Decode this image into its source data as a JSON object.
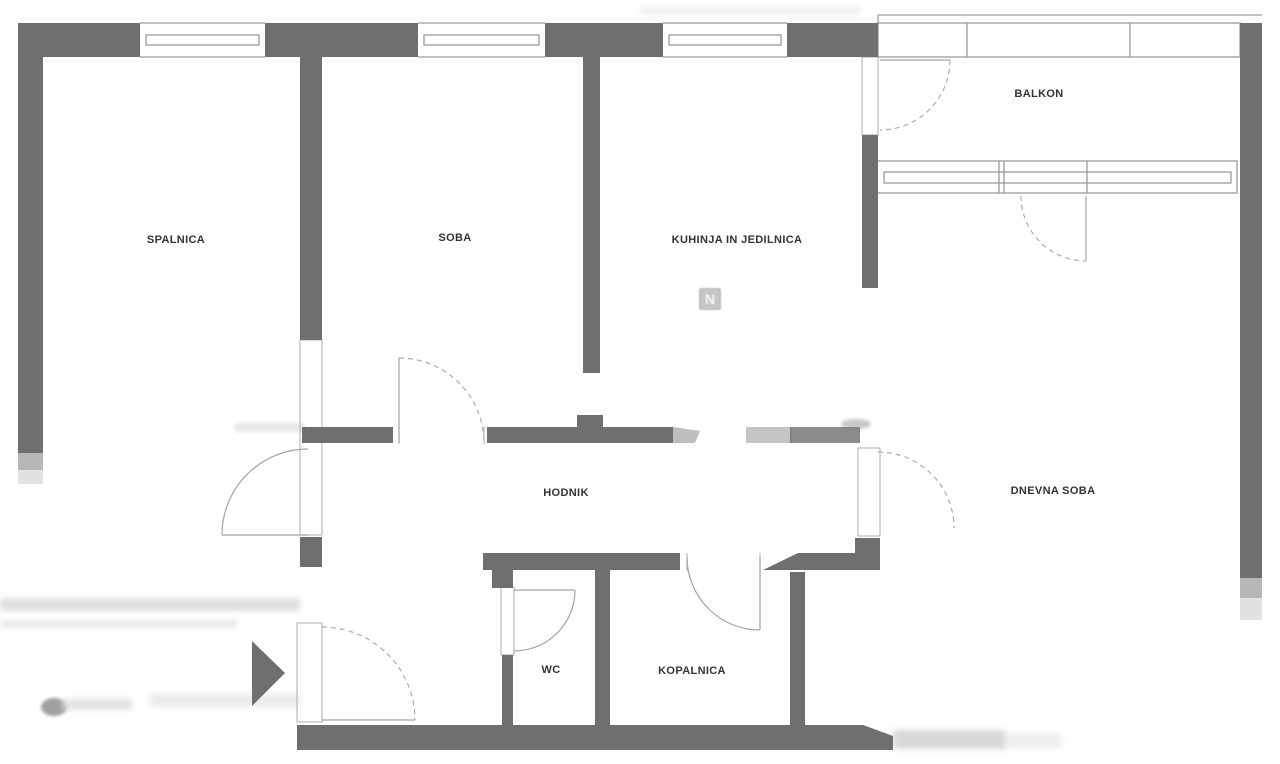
{
  "floorplan": {
    "labels": {
      "spalnica": "SPALNICA",
      "soba": "SOBA",
      "kuhinja": "KUHINJA IN JEDILNICA",
      "balkon": "BALKON",
      "hodnik": "HODNIK",
      "dnevna_soba": "DNEVNA SOBA",
      "wc": "WC",
      "kopalnica": "KOPALNICA"
    },
    "watermark": "N",
    "colors": {
      "wall": "#6f6f6f",
      "line": "#9a9a9a",
      "label": "#333333",
      "background": "#ffffff"
    }
  }
}
